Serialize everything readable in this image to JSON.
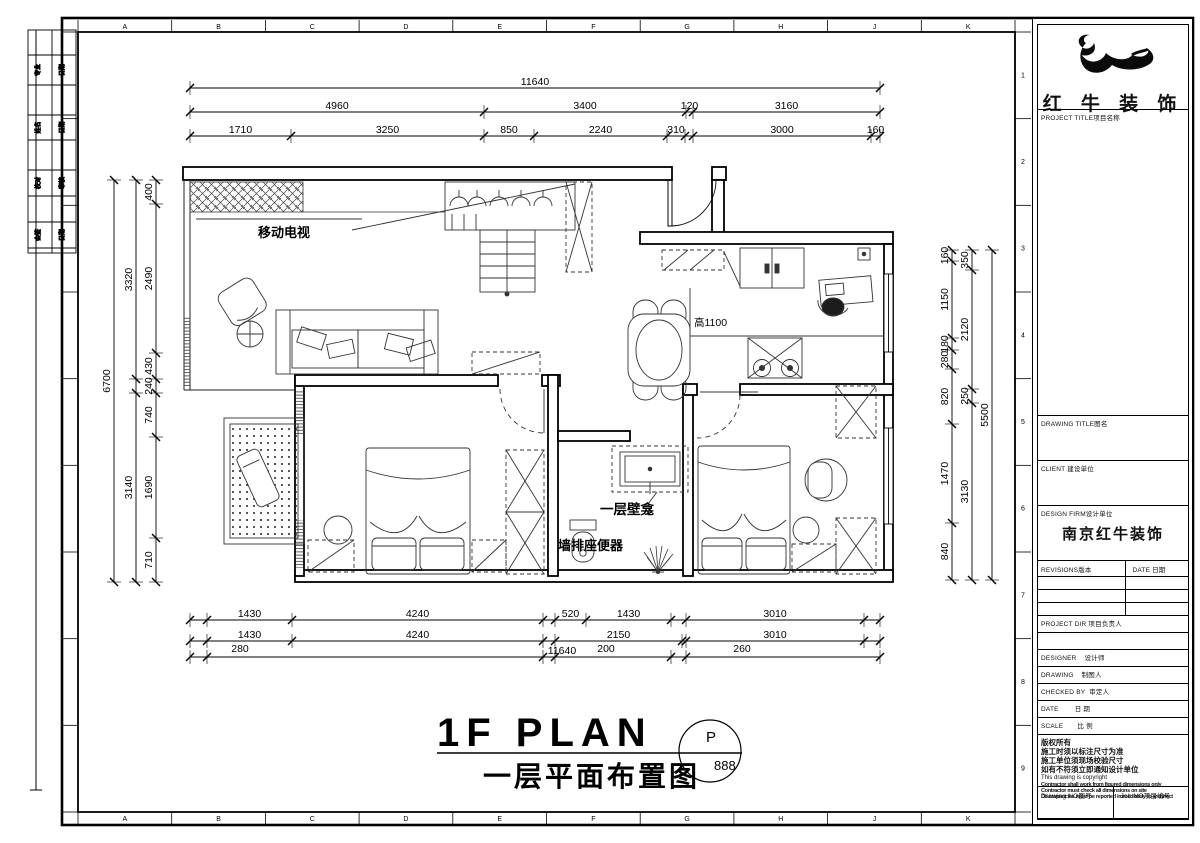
{
  "frame": {
    "top_letters": [
      "A",
      "B",
      "C",
      "D",
      "E",
      "F",
      "G",
      "H",
      "J",
      "K"
    ],
    "side_numbers": [
      "1",
      "2",
      "3",
      "4",
      "5",
      "6",
      "7",
      "8",
      "9"
    ]
  },
  "sign_strip": {
    "rows": [
      [
        "专业",
        "日期"
      ],
      [
        "姓名",
        "日期"
      ],
      [
        "校对",
        "审核"
      ],
      [
        "会签",
        "日期"
      ]
    ]
  },
  "plan_labels": {
    "tv": "移动电视",
    "counter_height": "高1100",
    "niche": "一层壁龛",
    "toilet": "墙排座便器"
  },
  "dims": {
    "top": {
      "row1": [
        "11640"
      ],
      "row2": [
        "4960",
        "3400",
        "120",
        "3160"
      ],
      "row3": [
        "1710",
        "3250",
        "850",
        "2240",
        "310",
        "",
        "3000",
        "160"
      ]
    },
    "left": {
      "outer": [
        "6700"
      ],
      "middle": [
        "3320",
        "",
        "3140"
      ],
      "inner": [
        "400",
        "2490",
        "430",
        "240",
        "740",
        "1690",
        "710"
      ]
    },
    "right": {
      "outer": [
        "5500"
      ],
      "middle": [
        "350",
        "2120",
        "250",
        "3130"
      ],
      "inner": [
        "160",
        "1150",
        "180",
        "280",
        "820",
        "1470",
        "840"
      ]
    },
    "bottom": {
      "row1": [
        "",
        "1430",
        "4240",
        "",
        "520",
        "1430",
        "",
        "3010",
        ""
      ],
      "row2": [
        "",
        "1430",
        "4240",
        "",
        "2150",
        "",
        "3010",
        ""
      ],
      "row3": [
        "280",
        "11640",
        "200",
        "260"
      ]
    }
  },
  "title": {
    "en": "1F PLAN",
    "zh": "一层平面布置图",
    "bubble_top": "P",
    "bubble_bottom": "888"
  },
  "titleblock": {
    "brand": "红 牛 装 饰",
    "project_label": "PROJECT TITLE项目名称",
    "drawing_title_label": "DRAWING TITLE图名",
    "client_label": "CLIENT 建设单位",
    "design_firm_label": "DESIGN FIRM设计单位",
    "design_firm_value": "南京红牛装饰",
    "revisions_label": "REVISIONS版本",
    "date_label": "DATE 日期",
    "project_dir_label": "PROJECT DIR 项目负责人",
    "designer_label": "DESIGNER    设计师",
    "drawing_label": "DRAWING    制图人",
    "checked_label": "CHECKED BY  审定人",
    "date2_label": "DATE        日 期",
    "scale_label": "SCALE       比 例",
    "copyright_zh1": "版权所有",
    "copyright_zh2": "施工时须以标注尺寸为准",
    "copyright_zh3": "施工单位须现场校验尺寸",
    "copyright_zh4": "如有不符须立即通知设计单位",
    "copyright_en0": "This drawing is copyright",
    "copyright_en1": "Contractor shall work from figured dimensions only",
    "copyright_en2": "Contractor must check all dimensions on site",
    "copyright_en3": "Discrepancies must be reported immediately to architect",
    "drawing_no_label": "Drawing NO图号",
    "job_no_label": "Job NO项目编号"
  }
}
